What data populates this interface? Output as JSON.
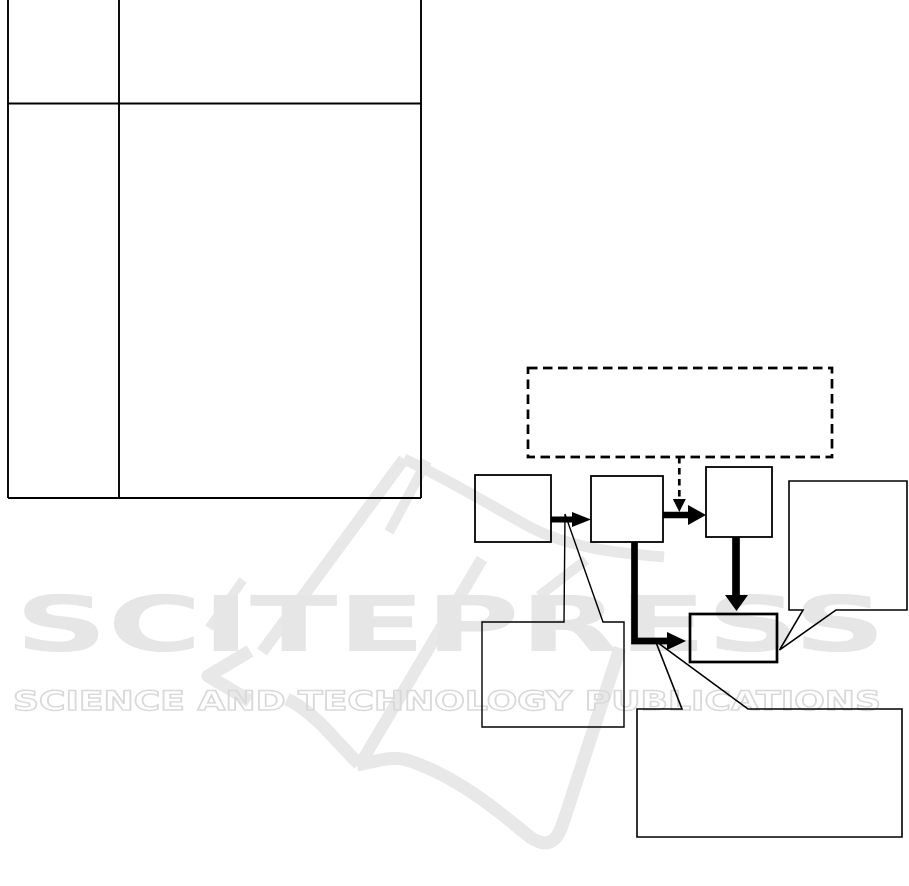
{
  "page": {
    "background_color": "#ffffff",
    "line_color": "#000000"
  },
  "watermark": {
    "logo_text": "SCITEPRESS",
    "tagline": "SCIENCE AND TECHNOLOGY PUBLICATIONS",
    "logo_color": "#e6e6e6",
    "tagline_color": "#d9d9d9",
    "swoosh_color": "#e8e8e8"
  },
  "table": {
    "columns": 2,
    "rows": 2,
    "cells": [
      [
        "",
        ""
      ],
      [
        "",
        ""
      ]
    ]
  },
  "diagram": {
    "dashed_annotation_box": {
      "label": ""
    },
    "boxes": [
      {
        "id": "flow-box-a",
        "label": ""
      },
      {
        "id": "flow-box-b",
        "label": ""
      },
      {
        "id": "flow-box-c",
        "label": ""
      },
      {
        "id": "flow-box-e",
        "label": ""
      },
      {
        "id": "callout-left",
        "label": ""
      },
      {
        "id": "callout-right",
        "label": ""
      },
      {
        "id": "callout-bottom",
        "label": ""
      }
    ],
    "arrow_count": 5
  }
}
